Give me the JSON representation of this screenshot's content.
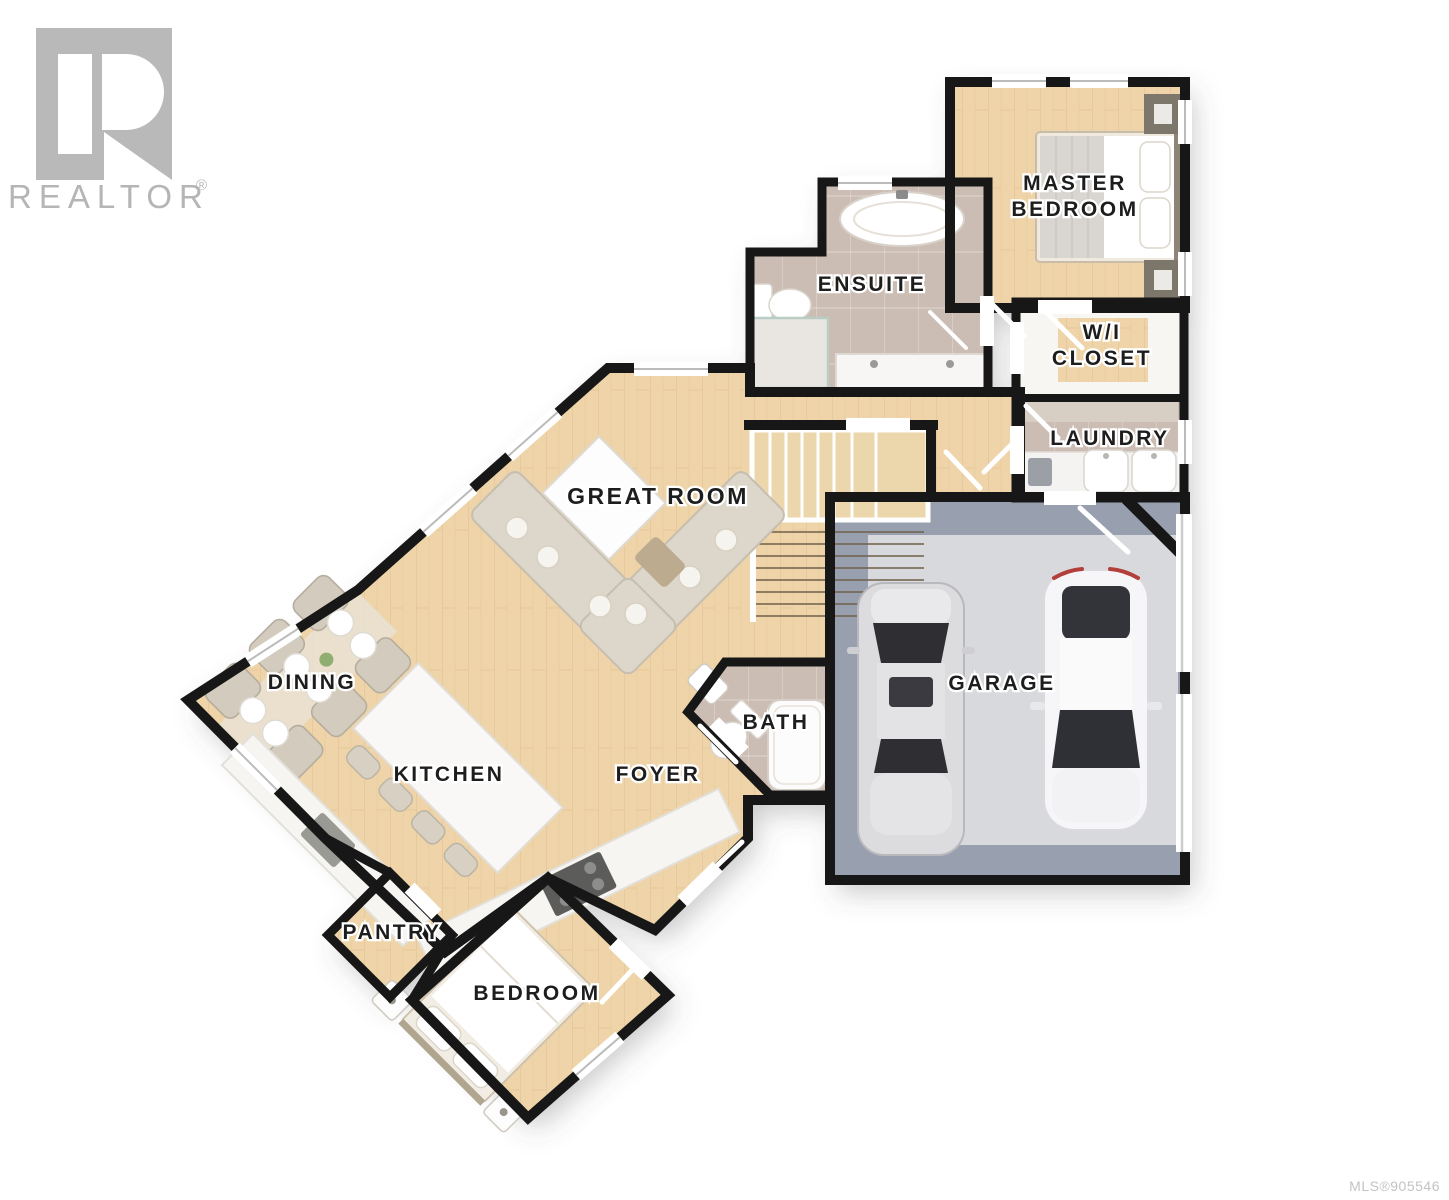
{
  "branding": {
    "logo_letter": "R",
    "logo_text": "REALTOR",
    "logo_reg": "®"
  },
  "footer": {
    "mls": "MLS®905546"
  },
  "colors": {
    "wall": "#171717",
    "wood_floor": "#eed4a8",
    "tile_floor": "#cbbdb3",
    "garage_border": "#98a0b0",
    "garage_floor": "#d8d9dc",
    "logo_gray": "#b5b5b5",
    "mls_gray": "#c3c3c3",
    "label_text": "#1d1d1d"
  },
  "rooms": [
    {
      "id": "master-bedroom",
      "lines": [
        "MASTER",
        "BEDROOM"
      ]
    },
    {
      "id": "ensuite",
      "lines": [
        "ENSUITE"
      ]
    },
    {
      "id": "wi-closet",
      "lines": [
        "W/I",
        "CLOSET"
      ]
    },
    {
      "id": "laundry",
      "lines": [
        "LAUNDRY"
      ]
    },
    {
      "id": "great-room",
      "lines": [
        "GREAT ROOM"
      ]
    },
    {
      "id": "dining",
      "lines": [
        "DINING"
      ]
    },
    {
      "id": "kitchen",
      "lines": [
        "KITCHEN"
      ]
    },
    {
      "id": "foyer",
      "lines": [
        "FOYER"
      ]
    },
    {
      "id": "bath",
      "lines": [
        "BATH"
      ]
    },
    {
      "id": "garage",
      "lines": [
        "GARAGE"
      ]
    },
    {
      "id": "pantry",
      "lines": [
        "PANTRY"
      ]
    },
    {
      "id": "bedroom",
      "lines": [
        "BEDROOM"
      ]
    }
  ]
}
